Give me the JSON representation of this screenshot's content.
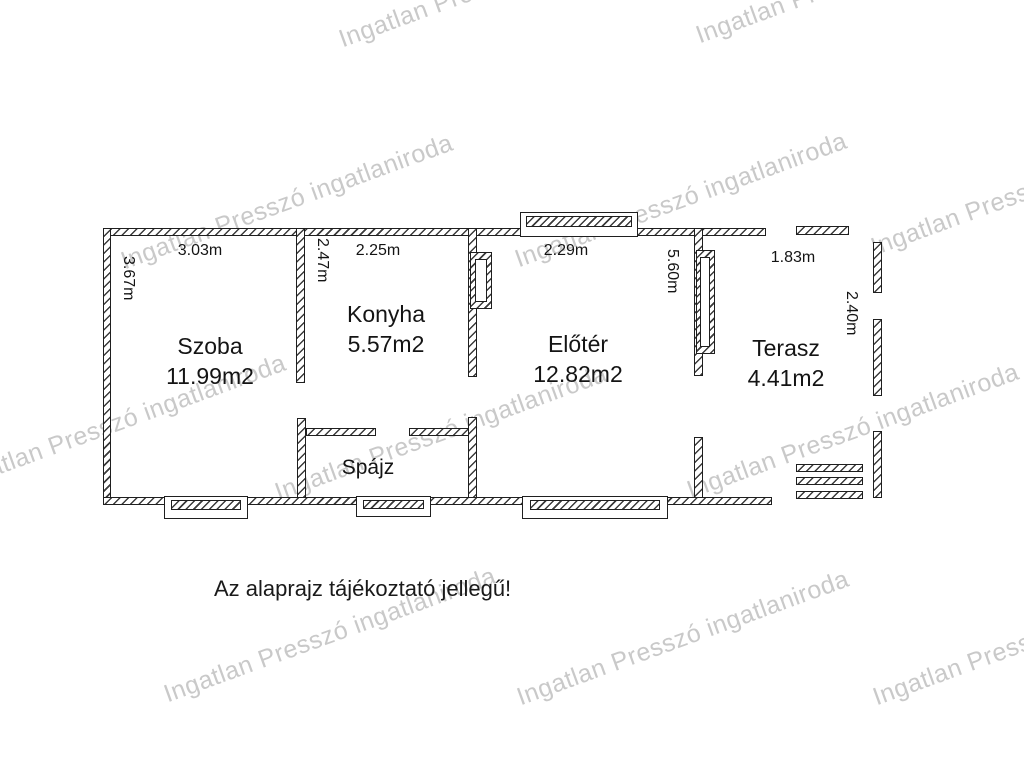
{
  "watermark": {
    "text": "Ingatlan Presszó ingatlaniroda",
    "color": "#c9c9c9"
  },
  "disclaimer": "Az alaprajz tájékoztató jellegű!",
  "rooms": {
    "szoba": {
      "name": "Szoba",
      "area": "11.99m2",
      "width_label": "3.03m",
      "height_label": "3.67m"
    },
    "konyha": {
      "name": "Konyha",
      "area": "5.57m2",
      "width_label": "2.25m",
      "height_label": "2.47m"
    },
    "eloter": {
      "name": "Előtér",
      "area": "12.82m2",
      "width_label": "2.29m",
      "height_label": "5.60m"
    },
    "terasz": {
      "name": "Terasz",
      "area": "4.41m2",
      "width_label": "1.83m",
      "height_label": "2.40m"
    },
    "spajz": {
      "name": "Spájz"
    }
  },
  "colors": {
    "wall_line": "#1f1f1f",
    "text": "#141414",
    "watermark": "#c9c9c9"
  }
}
